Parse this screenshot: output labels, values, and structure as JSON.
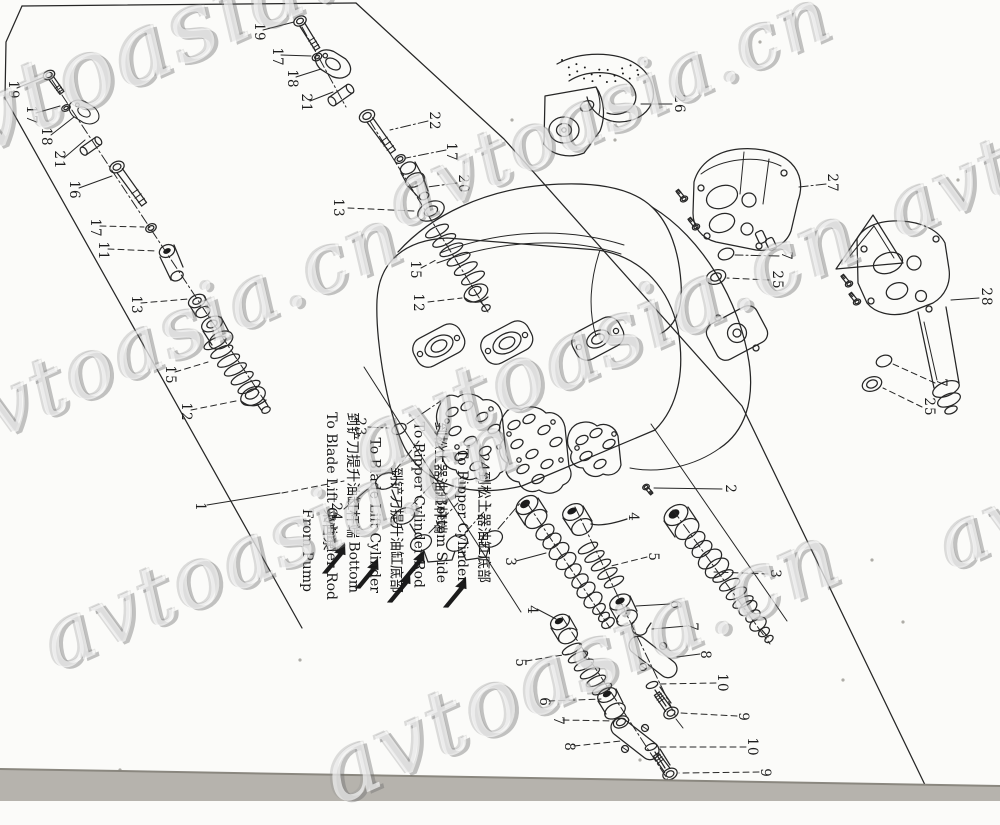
{
  "watermark": {
    "text": "avtoasia.cn"
  },
  "colors": {
    "ink": "#262626",
    "paper": "#fbfbf9",
    "scan_band": "#b6b3ad",
    "watermark_fill": "rgba(255,255,255,0.62)",
    "watermark_shadow": "#6c6c6c"
  },
  "part_labels": [
    {
      "text": "19",
      "x": 13,
      "y": 90
    },
    {
      "text": "17",
      "x": 31,
      "y": 115
    },
    {
      "text": "18",
      "x": 46,
      "y": 137
    },
    {
      "text": "21",
      "x": 59,
      "y": 160
    },
    {
      "text": "16",
      "x": 74,
      "y": 190
    },
    {
      "text": "17",
      "x": 95,
      "y": 228
    },
    {
      "text": "11",
      "x": 103,
      "y": 251
    },
    {
      "text": "13",
      "x": 136,
      "y": 305
    },
    {
      "text": "15",
      "x": 170,
      "y": 375
    },
    {
      "text": "12",
      "x": 186,
      "y": 412
    },
    {
      "text": "19",
      "x": 259,
      "y": 32
    },
    {
      "text": "17",
      "x": 277,
      "y": 57
    },
    {
      "text": "18",
      "x": 292,
      "y": 79
    },
    {
      "text": "21",
      "x": 306,
      "y": 103
    },
    {
      "text": "22",
      "x": 434,
      "y": 121
    },
    {
      "text": "17",
      "x": 451,
      "y": 152
    },
    {
      "text": "20",
      "x": 463,
      "y": 184
    },
    {
      "text": "13",
      "x": 338,
      "y": 208
    },
    {
      "text": "15",
      "x": 415,
      "y": 270
    },
    {
      "text": "12",
      "x": 418,
      "y": 303
    },
    {
      "text": "26",
      "x": 679,
      "y": 104
    },
    {
      "text": "27",
      "x": 832,
      "y": 183
    },
    {
      "text": "7",
      "x": 786,
      "y": 256
    },
    {
      "text": "25",
      "x": 777,
      "y": 280
    },
    {
      "text": "28",
      "x": 986,
      "y": 297
    },
    {
      "text": "7",
      "x": 941,
      "y": 383
    },
    {
      "text": "25",
      "x": 929,
      "y": 407
    },
    {
      "text": "1",
      "x": 200,
      "y": 507
    },
    {
      "text": "23",
      "x": 360,
      "y": 427
    },
    {
      "text": "24",
      "x": 336,
      "y": 512
    },
    {
      "text": "2",
      "x": 730,
      "y": 489
    },
    {
      "text": "3",
      "x": 510,
      "y": 562
    },
    {
      "text": "4",
      "x": 532,
      "y": 610
    },
    {
      "text": "5",
      "x": 520,
      "y": 663
    },
    {
      "text": "6",
      "x": 544,
      "y": 702
    },
    {
      "text": "7",
      "x": 558,
      "y": 721
    },
    {
      "text": "8",
      "x": 569,
      "y": 747
    },
    {
      "text": "4",
      "x": 633,
      "y": 517
    },
    {
      "text": "5",
      "x": 653,
      "y": 557
    },
    {
      "text": "6",
      "x": 675,
      "y": 605
    },
    {
      "text": "7",
      "x": 692,
      "y": 627
    },
    {
      "text": "8",
      "x": 705,
      "y": 655
    },
    {
      "text": "10",
      "x": 722,
      "y": 683
    },
    {
      "text": "9",
      "x": 743,
      "y": 717
    },
    {
      "text": "10",
      "x": 752,
      "y": 747
    },
    {
      "text": "9",
      "x": 765,
      "y": 773
    },
    {
      "text": "3",
      "x": 775,
      "y": 574
    }
  ],
  "port_labels": [
    {
      "lines": [
        "来自泵",
        "From Pump"
      ],
      "x": 338,
      "y": 592,
      "align": "left"
    },
    {
      "lines": [
        "到铲刀提升油缸杆端",
        "To Blade Lift Cylinder Rod"
      ],
      "x": 362,
      "y": 600,
      "align": "left"
    },
    {
      "lines": [
        "到铲刀提升油缸底部",
        "To Blade Lift Cylinder",
        "Bottom"
      ],
      "x": 406,
      "y": 593,
      "align": "right"
    },
    {
      "lines": [
        "到松土器油缸杆端",
        "To Ripper Cylinder Rod"
      ],
      "x": 449,
      "y": 588,
      "align": "left"
    },
    {
      "lines": [
        "24到松土器油缸底部",
        "To Ripper Cylinder",
        "Bottom Side"
      ],
      "x": 493,
      "y": 583,
      "align": "right"
    }
  ]
}
